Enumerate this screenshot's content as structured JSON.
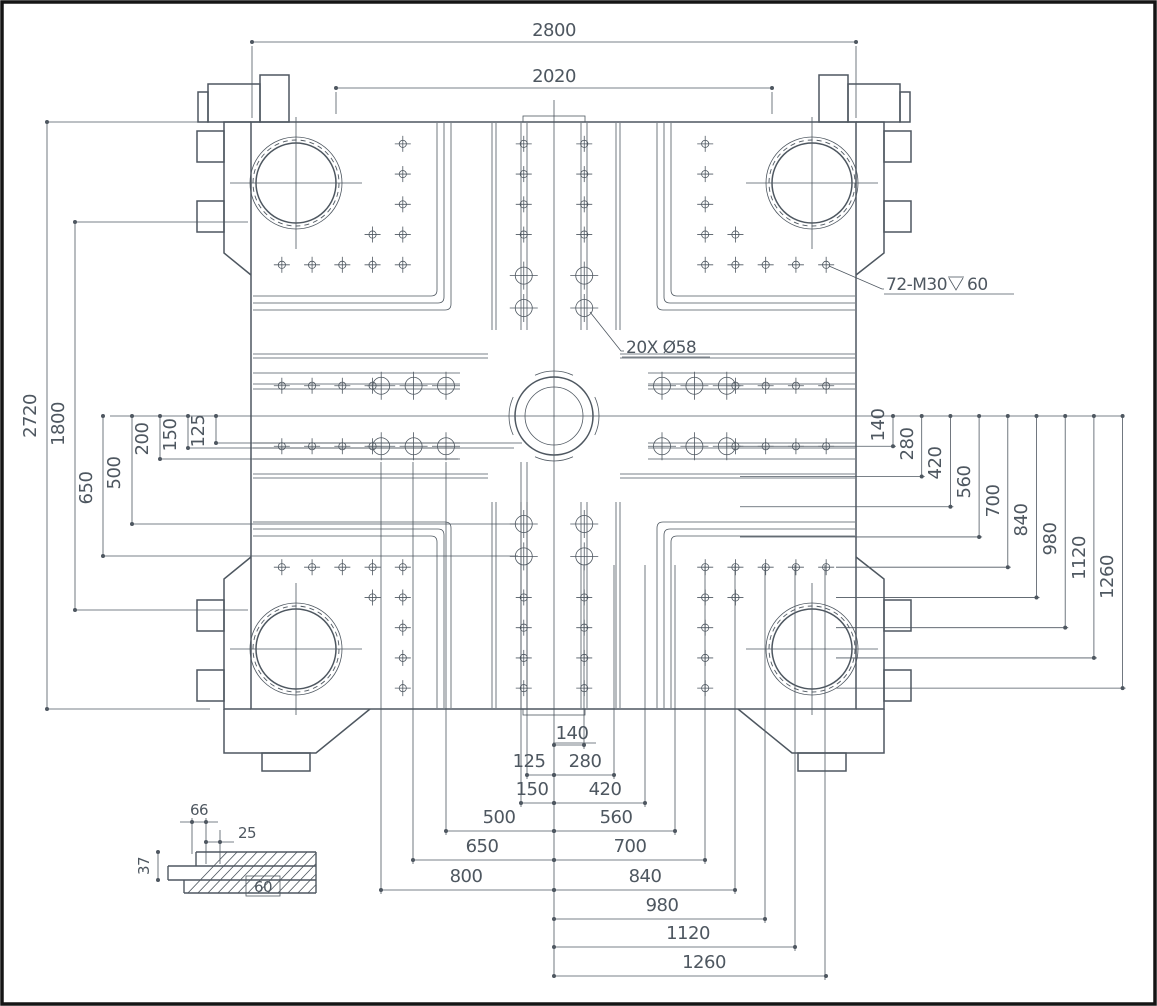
{
  "dims": {
    "top": [
      "2800",
      "2020"
    ],
    "left": [
      "2720",
      "1800",
      "650",
      "500",
      "200",
      "150",
      "125"
    ],
    "right": [
      "140",
      "280",
      "420",
      "560",
      "700",
      "840",
      "980",
      "1120",
      "1260"
    ],
    "bottom_left": [
      "125",
      "150",
      "500",
      "650",
      "800"
    ],
    "bottom_center_right": [
      "140",
      "280",
      "420",
      "560",
      "700",
      "840",
      "980",
      "1120",
      "1260"
    ]
  },
  "annotations": {
    "thread_callout_prefix": "72-M30",
    "thread_callout_depth": "60",
    "hole_callout": "20X Ø58"
  },
  "detail": {
    "width": "66",
    "offset": "25",
    "depth": "37",
    "base": "60"
  }
}
